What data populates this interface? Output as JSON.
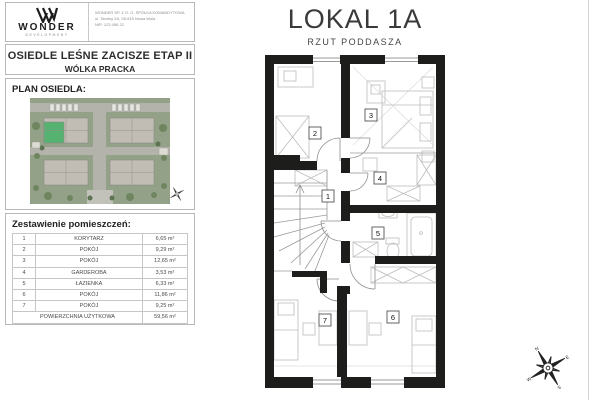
{
  "header": {
    "brand_name": "WONDER",
    "brand_sub": "DEVELOPMENT",
    "company_lines": [
      "WONDER SP. Z O. O. SPÓŁKA KOMANDYTOWA",
      "ul. Tarniny 2A, 05-515 Nowa Wola",
      "NIP: 123 456 22"
    ]
  },
  "project": {
    "title": "OSIEDLE LEŚNE ZACISZE ETAP II",
    "subtitle": "WÓLKA PRACKA"
  },
  "site_plan": {
    "label": "PLAN OSIEDLA:"
  },
  "rooms_table": {
    "title": "Zestawienie pomieszczeń:",
    "rows": [
      {
        "no": "1",
        "name": "KORYTARZ",
        "area": "6,65 m²"
      },
      {
        "no": "2",
        "name": "POKÓJ",
        "area": "9,29 m²"
      },
      {
        "no": "3",
        "name": "POKÓJ",
        "area": "12,65 m²"
      },
      {
        "no": "4",
        "name": "GARDEROBA",
        "area": "3,53 m²"
      },
      {
        "no": "5",
        "name": "ŁAZIENKA",
        "area": "6,33 m²"
      },
      {
        "no": "6",
        "name": "POKÓJ",
        "area": "11,86 m²"
      },
      {
        "no": "7",
        "name": "POKÓJ",
        "area": "9,25 m²"
      }
    ],
    "total_label": "POWIERZCHNIA UŻYTKOWA",
    "total_area": "59,56 m²"
  },
  "unit": {
    "title": "LOKAL 1A",
    "subtitle": "RZUT PODDASZA",
    "room_numbers": [
      "1",
      "2",
      "3",
      "4",
      "5",
      "6",
      "7"
    ]
  },
  "colors": {
    "wall": "#1d1d1b",
    "highlight_green": "#55b271",
    "site_background": "#93a188"
  }
}
